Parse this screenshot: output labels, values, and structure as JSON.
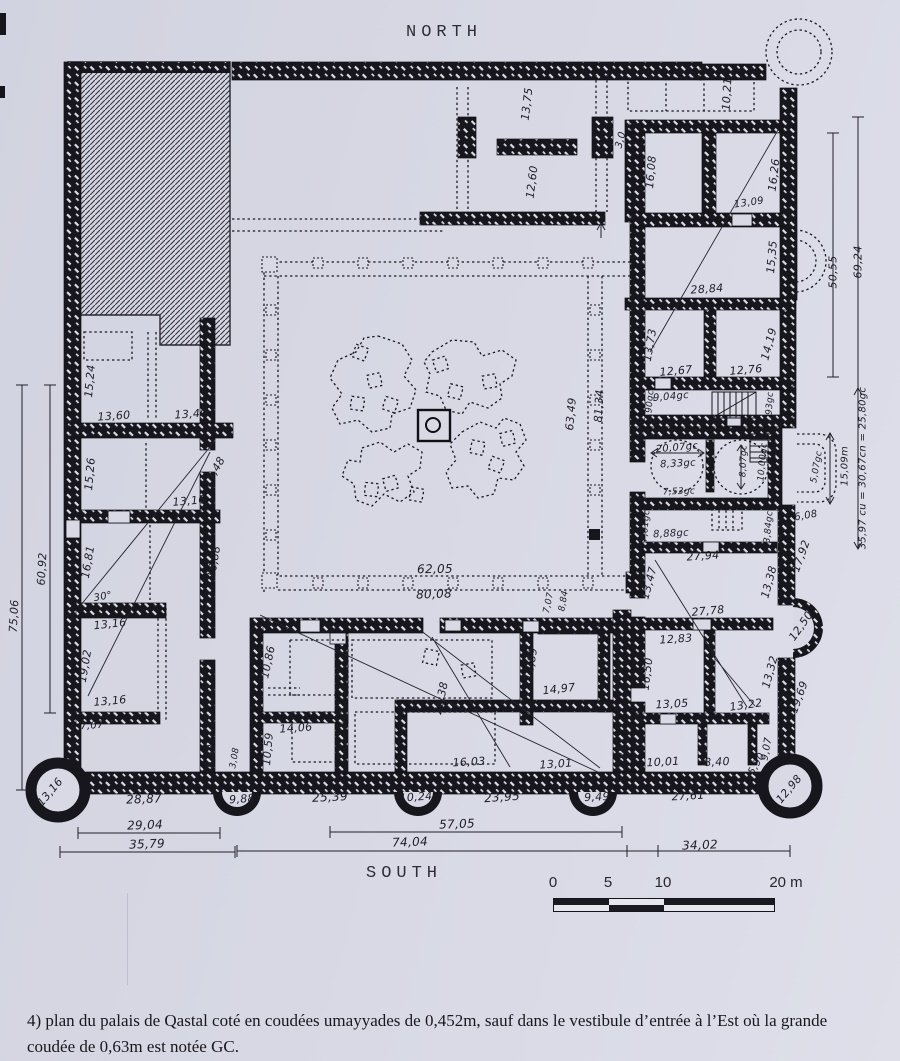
{
  "colors": {
    "paper": "#d8d9e5",
    "ink": "#15151b"
  },
  "compass": {
    "north_label": "NORTH",
    "south_label": "SOUTH"
  },
  "caption": {
    "line1": "4) plan du palais de Qastal coté en coudées umayyades de 0,452m, sauf dans le vestibule d’entrée à l’Est où la grande",
    "line2": "coudée de 0,63m est notée GC."
  },
  "scale_bar": {
    "tick0": "0",
    "tick5": "5",
    "tick10": "10",
    "tick20": "20 m"
  },
  "plan": {
    "units_note": "dimensions in Umayyad cubits of 0,452m; GC = grande coudée of 0,63m",
    "dimension_labels": [
      {
        "t": "13,75",
        "x": 527,
        "y": 104,
        "r": -83
      },
      {
        "t": "12,60",
        "x": 532,
        "y": 182,
        "r": -83
      },
      {
        "t": "3,0",
        "x": 621,
        "y": 140,
        "r": -75,
        "s": 10
      },
      {
        "t": "10,21",
        "x": 727,
        "y": 94,
        "r": -87
      },
      {
        "t": "16,08",
        "x": 651,
        "y": 172,
        "r": -85
      },
      {
        "t": "16,26",
        "x": 774,
        "y": 175,
        "r": -83
      },
      {
        "t": "13,09",
        "x": 749,
        "y": 203,
        "r": -8,
        "s": 10
      },
      {
        "t": "15,35",
        "x": 772,
        "y": 257,
        "r": -85
      },
      {
        "t": "28,84",
        "x": 707,
        "y": 289,
        "r": -4
      },
      {
        "t": "50,55",
        "x": 833,
        "y": 272,
        "r": -90
      },
      {
        "t": "69,24",
        "x": 858,
        "y": 262,
        "r": -90
      },
      {
        "t": "13,73",
        "x": 650,
        "y": 345,
        "r": -80
      },
      {
        "t": "14,19",
        "x": 769,
        "y": 344,
        "r": -75
      },
      {
        "t": "12,67",
        "x": 676,
        "y": 371,
        "r": -5
      },
      {
        "t": "12,76",
        "x": 746,
        "y": 370,
        "r": -5
      },
      {
        "t": "9,04gc",
        "x": 671,
        "y": 397,
        "r": -5,
        "s": 10
      },
      {
        "t": "3,90gc",
        "x": 650,
        "y": 406,
        "r": -85,
        "s": 9
      },
      {
        "t": "3,93gc",
        "x": 770,
        "y": 408,
        "r": -87,
        "s": 9
      },
      {
        "t": "20,07gc",
        "x": 677,
        "y": 448,
        "r": -5,
        "s": 10
      },
      {
        "t": "8,33gc",
        "x": 678,
        "y": 464,
        "r": -3,
        "s": 10
      },
      {
        "t": "7,53gc",
        "x": 679,
        "y": 492,
        "r": -2,
        "s": 9
      },
      {
        "t": "8,07gc",
        "x": 744,
        "y": 461,
        "r": -88,
        "s": 9
      },
      {
        "t": "10,00gc",
        "x": 763,
        "y": 462,
        "r": -85,
        "s": 9
      },
      {
        "t": "5,07gc",
        "x": 817,
        "y": 467,
        "r": -80,
        "s": 9
      },
      {
        "t": "6,08",
        "x": 806,
        "y": 516,
        "r": -10,
        "s": 10
      },
      {
        "t": "3,84gc",
        "x": 769,
        "y": 527,
        "r": -85,
        "s": 9
      },
      {
        "t": "7,01gc",
        "x": 646,
        "y": 526,
        "r": -85,
        "s": 9
      },
      {
        "t": "8,88gc",
        "x": 671,
        "y": 534,
        "r": -3,
        "s": 10
      },
      {
        "t": "27,94",
        "x": 703,
        "y": 556,
        "r": -4
      },
      {
        "t": "17,92",
        "x": 801,
        "y": 556,
        "r": -70
      },
      {
        "t": "15,09m",
        "x": 845,
        "y": 466,
        "r": -90,
        "s": 10
      },
      {
        "t": "35,97 cu = 30,67cn = 25,80gc",
        "x": 863,
        "y": 468,
        "r": -90,
        "s": 10
      },
      {
        "t": "13,47",
        "x": 649,
        "y": 583,
        "r": -75
      },
      {
        "t": "27,78",
        "x": 708,
        "y": 611,
        "r": -5
      },
      {
        "t": "13,38",
        "x": 769,
        "y": 582,
        "r": -75
      },
      {
        "t": "12,83",
        "x": 676,
        "y": 639,
        "r": -4
      },
      {
        "t": "16,50",
        "x": 647,
        "y": 674,
        "r": -83
      },
      {
        "t": "13,05",
        "x": 672,
        "y": 704,
        "r": -3
      },
      {
        "t": "13,32",
        "x": 770,
        "y": 672,
        "r": -75
      },
      {
        "t": "13,22",
        "x": 746,
        "y": 705,
        "r": -8
      },
      {
        "t": "12,50",
        "x": 801,
        "y": 626,
        "r": -55
      },
      {
        "t": "19,69",
        "x": 799,
        "y": 697,
        "r": -70
      },
      {
        "t": "9,07",
        "x": 767,
        "y": 749,
        "r": -80,
        "s": 10
      },
      {
        "t": "3,08",
        "x": 621,
        "y": 757,
        "r": -75,
        "s": 9
      },
      {
        "t": "10,01",
        "x": 663,
        "y": 762,
        "r": -3
      },
      {
        "t": "8,40",
        "x": 717,
        "y": 762,
        "r": -3
      },
      {
        "t": "5,90",
        "x": 757,
        "y": 764,
        "r": -60,
        "s": 10
      },
      {
        "t": "27,61",
        "x": 688,
        "y": 796,
        "r": -3
      },
      {
        "t": "12,98",
        "x": 789,
        "y": 789,
        "r": -50
      },
      {
        "t": "9,49",
        "x": 597,
        "y": 797,
        "r": -3
      },
      {
        "t": "34,02",
        "x": 700,
        "y": 845,
        "r": -2,
        "s": 12
      },
      {
        "t": "10,86",
        "x": 268,
        "y": 662,
        "r": -78
      },
      {
        "t": "14,06",
        "x": 296,
        "y": 728,
        "r": -4
      },
      {
        "t": "10,59",
        "x": 268,
        "y": 749,
        "r": -85
      },
      {
        "t": "25,39",
        "x": 330,
        "y": 797,
        "r": -3,
        "s": 12
      },
      {
        "t": "10,24",
        "x": 416,
        "y": 797,
        "r": -4
      },
      {
        "t": "28,38",
        "x": 441,
        "y": 698,
        "r": -78
      },
      {
        "t": "16,03",
        "x": 469,
        "y": 762,
        "r": -3
      },
      {
        "t": "23,95",
        "x": 502,
        "y": 797,
        "r": -4,
        "s": 12
      },
      {
        "t": "12,89",
        "x": 531,
        "y": 664,
        "r": -80
      },
      {
        "t": "14,97",
        "x": 559,
        "y": 689,
        "r": -6
      },
      {
        "t": "13,01",
        "x": 556,
        "y": 764,
        "r": -4
      },
      {
        "t": "57,05",
        "x": 457,
        "y": 824,
        "r": -2,
        "s": 12
      },
      {
        "t": "74,04",
        "x": 410,
        "y": 842,
        "r": -2,
        "s": 12
      },
      {
        "t": "7,07",
        "x": 549,
        "y": 603,
        "r": -78,
        "s": 9
      },
      {
        "t": "8,84",
        "x": 564,
        "y": 601,
        "r": -80,
        "s": 9
      },
      {
        "t": "15,24",
        "x": 90,
        "y": 381,
        "r": -85
      },
      {
        "t": "13,60",
        "x": 114,
        "y": 416,
        "r": -4
      },
      {
        "t": "13,40",
        "x": 191,
        "y": 414,
        "r": -4
      },
      {
        "t": "15,26",
        "x": 90,
        "y": 474,
        "r": -85
      },
      {
        "t": "15,48",
        "x": 214,
        "y": 472,
        "r": -60
      },
      {
        "t": "13,16",
        "x": 189,
        "y": 501,
        "r": -5
      },
      {
        "t": "16,81",
        "x": 88,
        "y": 562,
        "r": -80
      },
      {
        "t": "16,88",
        "x": 214,
        "y": 562,
        "r": -80
      },
      {
        "t": "60,92",
        "x": 42,
        "y": 569,
        "r": -87
      },
      {
        "t": "75,06",
        "x": 14,
        "y": 616,
        "r": -87
      },
      {
        "t": "30°",
        "x": 103,
        "y": 597,
        "r": -10,
        "s": 10
      },
      {
        "t": "13,16",
        "x": 110,
        "y": 624,
        "r": -6
      },
      {
        "t": "19,02",
        "x": 85,
        "y": 666,
        "r": -80
      },
      {
        "t": "13,16",
        "x": 110,
        "y": 701,
        "r": -5
      },
      {
        "t": "7,07",
        "x": 92,
        "y": 726,
        "r": -4,
        "s": 10
      },
      {
        "t": "6,52",
        "x": 211,
        "y": 756,
        "r": -83,
        "s": 10
      },
      {
        "t": "3,08",
        "x": 235,
        "y": 758,
        "r": -80,
        "s": 9
      },
      {
        "t": "13,16",
        "x": 50,
        "y": 792,
        "r": -50
      },
      {
        "t": "28,87",
        "x": 144,
        "y": 799,
        "r": -2,
        "s": 12
      },
      {
        "t": "9,88",
        "x": 242,
        "y": 799,
        "r": -4
      },
      {
        "t": "29,04",
        "x": 145,
        "y": 825,
        "r": -2,
        "s": 12
      },
      {
        "t": "35,79",
        "x": 147,
        "y": 844,
        "r": -2,
        "s": 12
      },
      {
        "t": "62,05",
        "x": 435,
        "y": 569,
        "r": -1,
        "s": 12
      },
      {
        "t": "80,08",
        "x": 434,
        "y": 594,
        "r": -2,
        "s": 12
      },
      {
        "t": "63,49",
        "x": 571,
        "y": 414,
        "r": -85
      },
      {
        "t": "81,34",
        "x": 599,
        "y": 406,
        "r": -87
      }
    ]
  }
}
